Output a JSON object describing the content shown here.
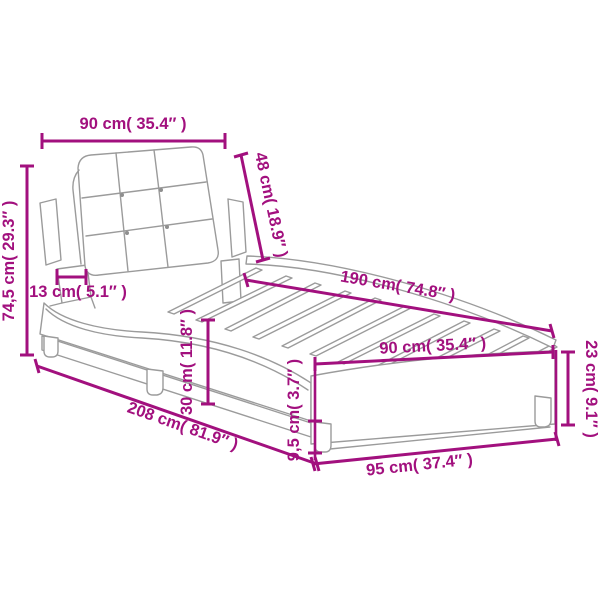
{
  "diagram": {
    "title": "bed-frame-with-upholstered-headboard-dimension-diagram",
    "background_color": "#ffffff",
    "accent_color": "#a2107e",
    "lineart_color": "#9b9b9b",
    "labels": {
      "top_width": "90 cm( 35.4″ )",
      "headboard_height": "48 cm( 18.9″ )",
      "total_height": "74,5 cm( 29.3″ )",
      "headboard_depth": "13 cm( 5.1″ )",
      "length": "190 cm( 74.8″ )",
      "slat_width": "90 cm( 35.4″ )",
      "side_height": "30 cm( 11.8″ )",
      "total_length": "208 cm( 81.9″ )",
      "leg_height": "9,5 cm( 3.7″ )",
      "foot_width": "95 cm( 37.4″ )",
      "foot_height": "23 cm( 9.1″ )"
    }
  }
}
